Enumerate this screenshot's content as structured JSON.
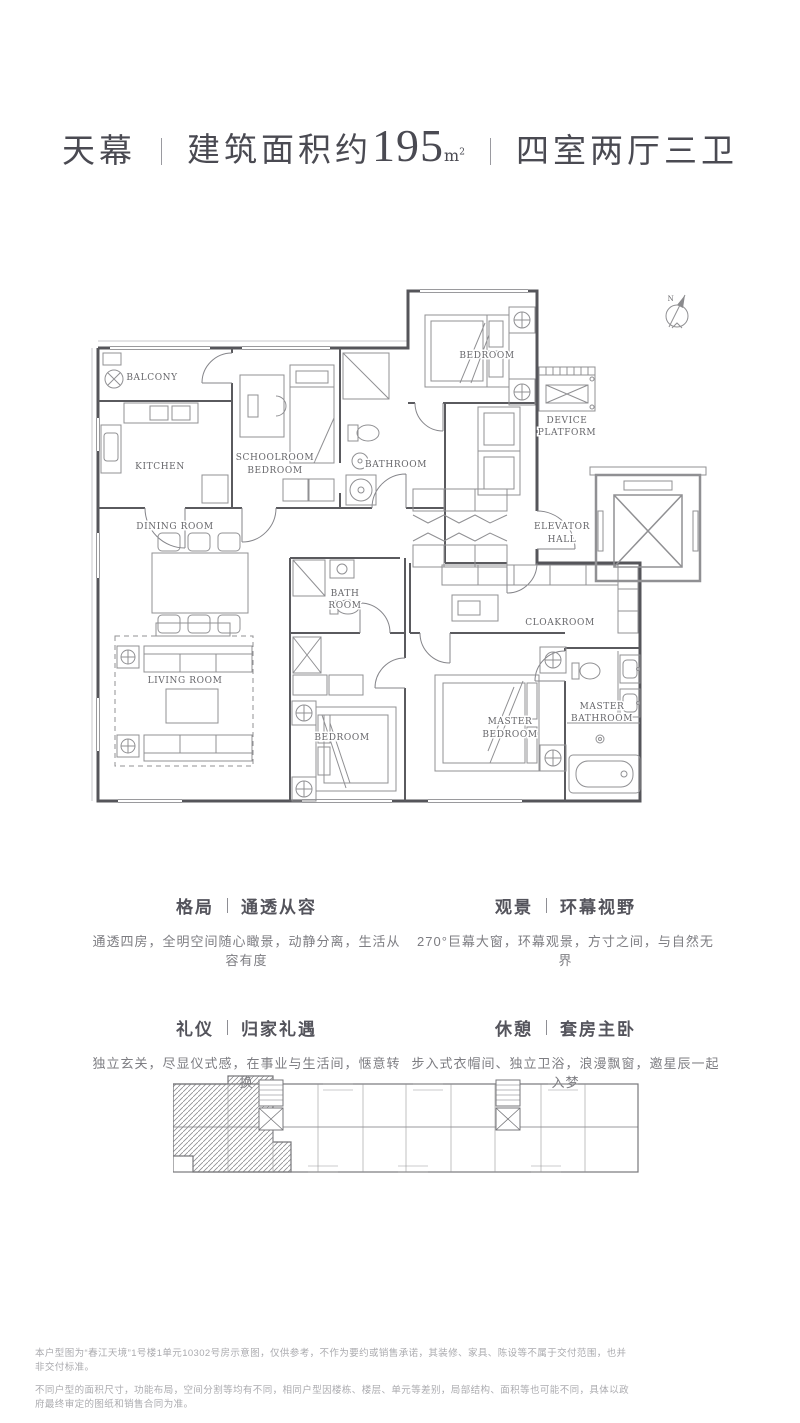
{
  "title": {
    "name": "天幕",
    "area_prefix": "建筑面积约",
    "area_number": "195",
    "area_unit_base": "m",
    "area_unit_sup": "2",
    "rooms_label": "四室两厅三卫"
  },
  "plan": {
    "compass_label": "N",
    "rooms": {
      "balcony": "BALCONY",
      "kitchen": "KITCHEN",
      "schoolroom_line1": "SCHOOLROOM",
      "schoolroom_line2": "BEDROOM",
      "bathroom": "BATHROOM",
      "bedroom_top": "BEDROOM",
      "device_line1": "DEVICE",
      "device_line2": "PLATFORM",
      "elevator_line1": "ELEVATOR",
      "elevator_line2": "HALL",
      "dining": "DINING ROOM",
      "living": "LIVING ROOM",
      "bath_line1": "BATH",
      "bath_line2": "ROOM",
      "bedroom_bottom": "BEDROOM",
      "master_line1": "MASTER",
      "master_line2": "BEDROOM",
      "masterbath_line1": "MASTER",
      "masterbath_line2": "BATHROOM",
      "cloakroom": "CLOAKROOM"
    }
  },
  "features": [
    {
      "tag": "格局",
      "title": "通透从容",
      "desc": "通透四房，全明空间随心瞰景，动静分离，生活从容有度"
    },
    {
      "tag": "观景",
      "title": "环幕视野",
      "desc": "270°巨幕大窗，环幕观景，方寸之间，与自然无界"
    },
    {
      "tag": "礼仪",
      "title": "归家礼遇",
      "desc": "独立玄关，尽显仪式感，在事业与生活间，惬意转换"
    },
    {
      "tag": "休憩",
      "title": "套房主卧",
      "desc": "步入式衣帽间、独立卫浴，浪漫飘窗，邀星辰一起入梦"
    }
  ],
  "disclaimer": {
    "line1": "本户型图为“春江天境”1号楼1单元10302号房示意图，仅供参考，不作为要约或销售承诺，其装修、家具、陈设等不属于交付范围，也并非交付标准。",
    "line2": "不同户型的面积尺寸，功能布局，空间分割等均有不同，相同户型因楼栋、楼层、单元等差别，局部结构、面积等也可能不同，具体以政府最终审定的图纸和销售合同为准。"
  },
  "colors": {
    "wall": "#55555a",
    "furniture": "#909093",
    "label": "#67676b",
    "title_text": "#4a4a52",
    "body_text": "#7d7d82",
    "disclaimer_text": "#ababaf"
  }
}
